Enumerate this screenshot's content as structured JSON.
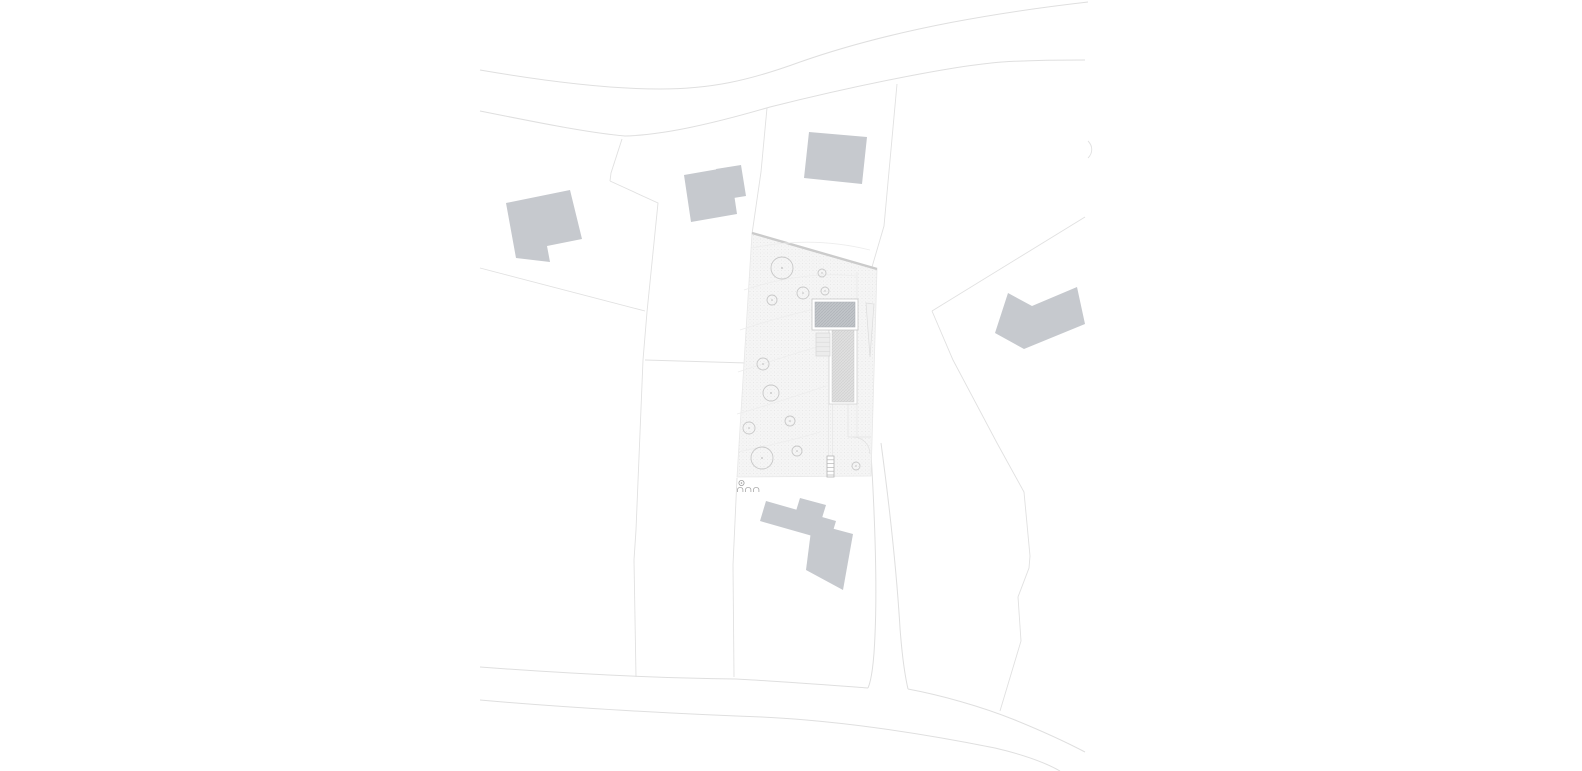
{
  "canvas": {
    "width": 1582,
    "height": 771,
    "background": "#ffffff"
  },
  "palette": {
    "building_fill": "#c6c9ce",
    "road_line": "#dfdfdf",
    "boundary_line": "#e1e1e1",
    "site_fill_base": "#f5f5f5",
    "site_dot": "#e2e2e2",
    "site_top_edge": "#cbcbcb",
    "tree_stroke": "#c8c8c8",
    "contour_line": "#ededed",
    "roof_hatch_base": "#c3c6ca",
    "roof_hatch_line": "#aeb2b7",
    "wing_hatch_base": "#e0e0e0",
    "wing_hatch_line": "#cfcfcf",
    "marker_stroke": "#9f9f9f"
  },
  "plan": {
    "type": "architectural-site-plan",
    "layers": [
      {
        "name": "roads",
        "kind": "path",
        "attrs": {
          "fill": "none",
          "stroke": "#dfdfdf",
          "stroke-width": "1"
        },
        "items": [
          {
            "name": "road-north-upper-edge",
            "attrs": {
              "d": "M480,70 C550,82 610,89 660,89 C710,89 748,81 800,62 C900,27 1010,11 1088,2"
            }
          },
          {
            "name": "road-north-lower-edge",
            "attrs": {
              "d": "M480,111 C540,123 590,133 625,136 C660,135 705,126 770,107 C850,87 950,66 1002,62 C1032,60 1062,60 1085,60"
            }
          },
          {
            "name": "road-south-upper-edge-west",
            "attrs": {
              "d": "M480,667 C560,673 650,678 736,679 C790,682 840,686 868,688"
            }
          },
          {
            "name": "road-south-upper-edge-east",
            "attrs": {
              "d": "M908,689 C940,695 980,706 1015,720 C1042,731 1066,742 1085,752"
            }
          },
          {
            "name": "road-south-lower-edge",
            "attrs": {
              "d": "M480,700 C570,708 680,714 762,717 C845,721 930,735 995,748 C1025,755 1046,763 1060,771"
            }
          },
          {
            "name": "driveway-west-edge",
            "attrs": {
              "d": "M871,453 C875,520 877,590 875,635 C874,660 872,679 868,688"
            }
          },
          {
            "name": "driveway-east-edge",
            "attrs": {
              "d": "M881,443 C890,510 897,578 900,628 C902,655 905,676 908,689"
            }
          }
        ]
      },
      {
        "name": "parcel-boundaries",
        "kind": "path",
        "attrs": {
          "fill": "none",
          "stroke": "#e1e1e1",
          "stroke-width": "0.9"
        },
        "items": [
          {
            "name": "boundary-west-upper",
            "attrs": {
              "d": "M622,139 L611,173 L610,181"
            }
          },
          {
            "name": "boundary-west-long",
            "attrs": {
              "d": "M610,181 L658,203 L647,312 L643,360 L636,530 L634,560 L636,677"
            }
          },
          {
            "name": "boundary-left-horizontal",
            "attrs": {
              "d": "M480,268 L645,311"
            }
          },
          {
            "name": "boundary-mid-horizontal",
            "attrs": {
              "d": "M645,360 L747,363"
            }
          },
          {
            "name": "boundary-site-north",
            "attrs": {
              "d": "M767,108 L761,172 L752,234"
            }
          },
          {
            "name": "boundary-south-west",
            "attrs": {
              "d": "M737,478 L733,565 L734,677"
            }
          },
          {
            "name": "boundary-north-east",
            "attrs": {
              "d": "M897,84 L884,226 L872,267"
            }
          },
          {
            "name": "boundary-diagonal-ne",
            "attrs": {
              "d": "M1085,217 L932,311"
            }
          },
          {
            "name": "boundary-east-curve",
            "attrs": {
              "d": "M932,311 L953,360 L997,443 L1024,492 L1030,556 L1029,568 L1018,597 L1021,641 L1000,711"
            }
          },
          {
            "name": "boundary-fragment-ne",
            "attrs": {
              "d": "M1088,141 C1093,146 1093,153 1088,158"
            }
          }
        ]
      },
      {
        "name": "project-parcel",
        "kind": "polygon",
        "attrs": {},
        "items": [
          {
            "name": "site-area",
            "attrs": {
              "points": "752,233 877,269 871,476 737,477",
              "fill": "url(#stipple)",
              "stroke": "#e8e8e8",
              "stroke-width": "0.8"
            }
          }
        ]
      },
      {
        "name": "site-edges",
        "kind": "path",
        "attrs": {
          "fill": "none"
        },
        "items": [
          {
            "name": "site-top-edge",
            "attrs": {
              "d": "M752,233 L877,269",
              "stroke": "#cbcbcb",
              "stroke-width": "2.4"
            }
          },
          {
            "name": "site-path-line",
            "attrs": {
              "d": "M857,272 L857,437",
              "stroke": "#e6e6e6",
              "stroke-width": "0.7"
            }
          }
        ]
      },
      {
        "name": "contours",
        "kind": "path",
        "attrs": {
          "fill": "none",
          "stroke": "#ededed",
          "stroke-width": "0.8"
        },
        "items": [
          {
            "name": "contour-line",
            "attrs": {
              "d": "M752,248 C790,240 830,240 870,250"
            }
          },
          {
            "name": "contour-line",
            "attrs": {
              "d": "M744,290 C780,278 820,272 856,276"
            }
          },
          {
            "name": "contour-line",
            "attrs": {
              "d": "M740,330 C770,320 800,312 828,306"
            }
          },
          {
            "name": "contour-line",
            "attrs": {
              "d": "M738,372 C768,362 798,352 828,344"
            }
          },
          {
            "name": "contour-line",
            "attrs": {
              "d": "M737,414 C766,406 796,396 826,386"
            }
          },
          {
            "name": "contour-line",
            "attrs": {
              "d": "M738,452 C766,446 794,440 820,432"
            }
          }
        ]
      },
      {
        "name": "trees",
        "kind": "circle",
        "attrs": {
          "fill": "none",
          "stroke": "#c8c8c8",
          "stroke-width": "0.9"
        },
        "items": [
          {
            "name": "tree",
            "attrs": {
              "cx": "782",
              "cy": "268",
              "r": "11"
            }
          },
          {
            "name": "tree",
            "attrs": {
              "cx": "822",
              "cy": "273",
              "r": "4"
            }
          },
          {
            "name": "tree",
            "attrs": {
              "cx": "803",
              "cy": "293",
              "r": "6"
            }
          },
          {
            "name": "tree",
            "attrs": {
              "cx": "825",
              "cy": "291",
              "r": "4"
            }
          },
          {
            "name": "tree",
            "attrs": {
              "cx": "772",
              "cy": "300",
              "r": "5"
            }
          },
          {
            "name": "tree",
            "attrs": {
              "cx": "763",
              "cy": "364",
              "r": "6"
            }
          },
          {
            "name": "tree",
            "attrs": {
              "cx": "771",
              "cy": "393",
              "r": "8"
            }
          },
          {
            "name": "tree",
            "attrs": {
              "cx": "790",
              "cy": "421",
              "r": "5"
            }
          },
          {
            "name": "tree",
            "attrs": {
              "cx": "749",
              "cy": "428",
              "r": "6"
            }
          },
          {
            "name": "tree",
            "attrs": {
              "cx": "762",
              "cy": "458",
              "r": "11"
            }
          },
          {
            "name": "tree",
            "attrs": {
              "cx": "797",
              "cy": "451",
              "r": "5"
            }
          },
          {
            "name": "tree",
            "attrs": {
              "cx": "856",
              "cy": "466",
              "r": "4"
            }
          }
        ]
      },
      {
        "name": "tree-centers",
        "kind": "circle",
        "attrs": {
          "fill": "#bdbdbd",
          "stroke": "none"
        },
        "items": [
          {
            "name": "tree-center-dot",
            "attrs": {
              "cx": "782",
              "cy": "268",
              "r": "0.9"
            }
          },
          {
            "name": "tree-center-dot",
            "attrs": {
              "cx": "822",
              "cy": "273",
              "r": "0.7"
            }
          },
          {
            "name": "tree-center-dot",
            "attrs": {
              "cx": "803",
              "cy": "293",
              "r": "0.8"
            }
          },
          {
            "name": "tree-center-dot",
            "attrs": {
              "cx": "825",
              "cy": "291",
              "r": "0.7"
            }
          },
          {
            "name": "tree-center-dot",
            "attrs": {
              "cx": "772",
              "cy": "300",
              "r": "0.8"
            }
          },
          {
            "name": "tree-center-dot",
            "attrs": {
              "cx": "763",
              "cy": "364",
              "r": "0.8"
            }
          },
          {
            "name": "tree-center-dot",
            "attrs": {
              "cx": "771",
              "cy": "393",
              "r": "0.9"
            }
          },
          {
            "name": "tree-center-dot",
            "attrs": {
              "cx": "790",
              "cy": "421",
              "r": "0.8"
            }
          },
          {
            "name": "tree-center-dot",
            "attrs": {
              "cx": "749",
              "cy": "428",
              "r": "0.8"
            }
          },
          {
            "name": "tree-center-dot",
            "attrs": {
              "cx": "762",
              "cy": "458",
              "r": "0.9"
            }
          },
          {
            "name": "tree-center-dot",
            "attrs": {
              "cx": "797",
              "cy": "451",
              "r": "0.8"
            }
          },
          {
            "name": "tree-center-dot",
            "attrs": {
              "cx": "856",
              "cy": "466",
              "r": "0.7"
            }
          }
        ]
      },
      {
        "name": "site-details",
        "kind": "path",
        "attrs": {
          "fill": "none",
          "stroke": "#e3e3e3",
          "stroke-width": "0.7"
        },
        "items": [
          {
            "name": "slope-mark",
            "kind": "polygon",
            "attrs": {
              "points": "866,303 874,304 870,357",
              "fill": "#f2f2f2",
              "stroke": "#dcdcdc",
              "stroke-width": "0.7"
            }
          },
          {
            "name": "court-wall-west",
            "attrs": {
              "d": "M848,404 L848,437"
            }
          },
          {
            "name": "court-wall-south",
            "attrs": {
              "d": "M848,437 L871,437"
            }
          },
          {
            "name": "gate-swing-arc",
            "attrs": {
              "d": "M853,437 A17,17 0 0 1 870,454",
              "stroke": "#e0e0e0"
            }
          },
          {
            "name": "path-edge",
            "attrs": {
              "d": "M828.5,404 L828.5,456",
              "stroke-width": "0.6"
            }
          },
          {
            "name": "path-edge",
            "attrs": {
              "d": "M832.5,404 L832.5,456",
              "stroke-width": "0.6"
            }
          },
          {
            "name": "exterior-steps",
            "kind": "rect",
            "attrs": {
              "x": "827",
              "y": "456",
              "width": "7",
              "height": "21",
              "fill": "#ffffff",
              "stroke": "#b5b5b5",
              "stroke-width": "0.8"
            }
          },
          {
            "name": "step-line",
            "attrs": {
              "d": "M827,459.8 h7",
              "stroke": "#b5b5b5"
            }
          },
          {
            "name": "step-line",
            "attrs": {
              "d": "M827,463.6 h7",
              "stroke": "#b5b5b5"
            }
          },
          {
            "name": "step-line",
            "attrs": {
              "d": "M827,467.4 h7",
              "stroke": "#b5b5b5"
            }
          },
          {
            "name": "step-line",
            "attrs": {
              "d": "M827,471.2 h7",
              "stroke": "#b5b5b5"
            }
          },
          {
            "name": "step-line",
            "attrs": {
              "d": "M827,475 h7",
              "stroke": "#b5b5b5"
            }
          }
        ]
      },
      {
        "name": "proposed-building",
        "kind": "rect",
        "attrs": {},
        "items": [
          {
            "name": "building-wing-frame",
            "attrs": {
              "x": "829",
              "y": "327",
              "width": "28",
              "height": "77",
              "fill": "#ffffff",
              "stroke": "#d2d2d2",
              "stroke-width": "0.8"
            }
          },
          {
            "name": "building-wing-hatch",
            "attrs": {
              "x": "832",
              "y": "330",
              "width": "22",
              "height": "72",
              "fill": "url(#hatchLight)",
              "stroke": "#cbcbcb",
              "stroke-width": "0.5"
            }
          },
          {
            "name": "building-roof-frame",
            "attrs": {
              "x": "812",
              "y": "299",
              "width": "46",
              "height": "31",
              "fill": "#ffffff",
              "stroke": "#c9c9c9",
              "stroke-width": "0.8"
            }
          },
          {
            "name": "building-roof-hatch",
            "attrs": {
              "x": "815",
              "y": "302",
              "width": "40",
              "height": "25",
              "fill": "url(#hatchDark)",
              "stroke": "#b0b4b9",
              "stroke-width": "0.6"
            }
          },
          {
            "name": "building-stair-block",
            "attrs": {
              "x": "816",
              "y": "333",
              "width": "14",
              "height": "23",
              "fill": "#ececec",
              "stroke": "#d5d5d5",
              "stroke-width": "0.7"
            }
          },
          {
            "name": "stair-tread-line",
            "kind": "path",
            "attrs": {
              "d": "M816,337.6 h14",
              "stroke": "#d8d8d8",
              "stroke-width": "0.6",
              "fill": "none"
            }
          },
          {
            "name": "stair-tread-line",
            "kind": "path",
            "attrs": {
              "d": "M816,342.2 h14",
              "stroke": "#d8d8d8",
              "stroke-width": "0.6",
              "fill": "none"
            }
          },
          {
            "name": "stair-tread-line",
            "kind": "path",
            "attrs": {
              "d": "M816,346.8 h14",
              "stroke": "#d8d8d8",
              "stroke-width": "0.6",
              "fill": "none"
            }
          },
          {
            "name": "stair-tread-line",
            "kind": "path",
            "attrs": {
              "d": "M816,351.4 h14",
              "stroke": "#d8d8d8",
              "stroke-width": "0.6",
              "fill": "none"
            }
          }
        ]
      },
      {
        "name": "neighbor-buildings",
        "kind": "polygon",
        "attrs": {
          "fill": "#c6c9ce",
          "stroke": "none"
        },
        "items": [
          {
            "name": "neighbor-building-west",
            "attrs": {
              "points": "506,203 570,190 582,239 547,246 550,262 516,258"
            }
          },
          {
            "name": "neighbor-building-mid",
            "attrs": {
              "points": "684,175 730,167 737,214 691,222"
            }
          },
          {
            "name": "neighbor-building-mid-annex",
            "attrs": {
              "points": "716,169 741,165 746,196 721,200"
            }
          },
          {
            "name": "neighbor-building-north",
            "attrs": {
              "points": "809,132 867,137 862,184 804,178"
            }
          },
          {
            "name": "neighbor-building-east",
            "attrs": {
              "points": "1008,293 1032,306 1077,287 1085,324 1024,349 995,333"
            }
          },
          {
            "name": "neighbor-building-south-upper",
            "attrs": {
              "points": "766,501 836,521 830,541 760,521"
            }
          },
          {
            "name": "neighbor-building-south-lower",
            "attrs": {
              "points": "812,523 853,534 843,590 806,570"
            }
          },
          {
            "name": "neighbor-building-south-tab",
            "attrs": {
              "points": "800,498 826,505 822,518 796,511"
            }
          }
        ]
      },
      {
        "name": "site-marker",
        "kind": "path",
        "attrs": {
          "fill": "none",
          "stroke": "#a8a8a8",
          "stroke-width": "0.8"
        },
        "items": [
          {
            "name": "marker-circle",
            "kind": "circle",
            "attrs": {
              "cx": "741.5",
              "cy": "483",
              "r": "2.6",
              "stroke": "#9f9f9f",
              "fill": "none"
            }
          },
          {
            "name": "marker-dot",
            "kind": "circle",
            "attrs": {
              "cx": "741.5",
              "cy": "483",
              "r": "0.8",
              "fill": "#9f9f9f",
              "stroke": "none"
            }
          },
          {
            "name": "marker-arch",
            "attrs": {
              "d": "M737.5,492 v-2.2 a2.7,2.4 0 0 1 5.4,0 v2.2"
            }
          },
          {
            "name": "marker-arch",
            "attrs": {
              "d": "M745.5,492 v-2.2 a2.7,2.4 0 0 1 5.4,0 v2.2"
            }
          },
          {
            "name": "marker-arch",
            "attrs": {
              "d": "M753.5,492 v-2.2 a2.7,2.4 0 0 1 5.4,0 v2.2"
            }
          }
        ]
      }
    ]
  }
}
